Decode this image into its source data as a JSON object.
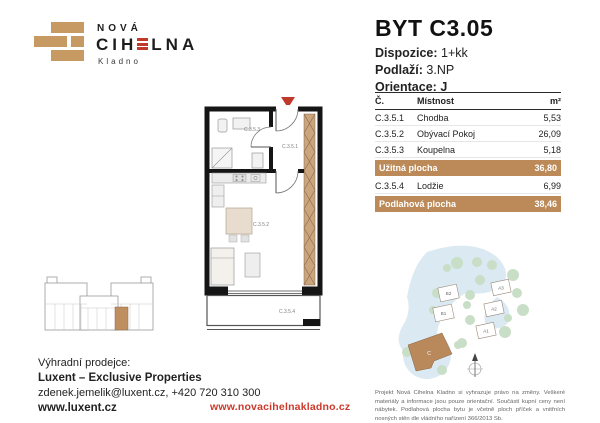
{
  "brand": {
    "name_top": "NOVÁ",
    "name_main_left": "CIH",
    "name_main_right": "LNA",
    "name_sub": "Kladno"
  },
  "unit": {
    "title": "BYT C3.05",
    "dispozice_label": "Dispozice:",
    "dispozice_value": "1+kk",
    "podlazi_label": "Podlaží:",
    "podlazi_value": "3.NP",
    "orientace_label": "Orientace:",
    "orientace_value": "J"
  },
  "table": {
    "headers": {
      "num": "Č.",
      "room": "Místnost",
      "area": "m²"
    },
    "rows": [
      {
        "num": "C.3.5.1",
        "room": "Chodba",
        "area": "5,53"
      },
      {
        "num": "C.3.5.2",
        "room": "Obývací Pokoj",
        "area": "26,09"
      },
      {
        "num": "C.3.5.3",
        "room": "Koupelna",
        "area": "5,18"
      }
    ],
    "uzitna": {
      "label": "Užitná plocha",
      "value": "36,80"
    },
    "extra_row": {
      "num": "C.3.5.4",
      "room": "Lodžie",
      "area": "6,99"
    },
    "podlahova": {
      "label": "Podlahová plocha",
      "value": "38,46"
    }
  },
  "floorplan": {
    "labels": {
      "chodba": "C.3.5.1",
      "obyvaci": "C.3.5.2",
      "koupelna": "C.3.5.3",
      "lodzie": "C.3.5.4"
    }
  },
  "siteplan": {
    "buildings": [
      "B2",
      "B1",
      "A3",
      "A2",
      "A1"
    ],
    "highlight": "C"
  },
  "footer": {
    "seller_label": "Výhradní prodejce:",
    "seller_name": "Luxent – Exclusive Properties",
    "seller_contact": "zdenek.jemelik@luxent.cz, +420 720 310 300",
    "seller_web": "www.luxent.cz",
    "site_web": "www.novacihelnakladno.cz",
    "disclaimer": "Projekt Nová Cihelna Kladno si vyhrazuje právo na změny. Veškeré materiály a informace jsou pouze orientační. Součástí kupní ceny není nábytek. Podlahová plocha bytu je včetně ploch příček a vnitřních nosných stěn dle vládního nařízení 366/2013 Sb."
  },
  "colors": {
    "tan": "#bc8a58",
    "brick_tan": "#c69a62",
    "red": "#c0392b",
    "tree_green": "#c9dec6",
    "path_blue": "#dbe9f3"
  }
}
